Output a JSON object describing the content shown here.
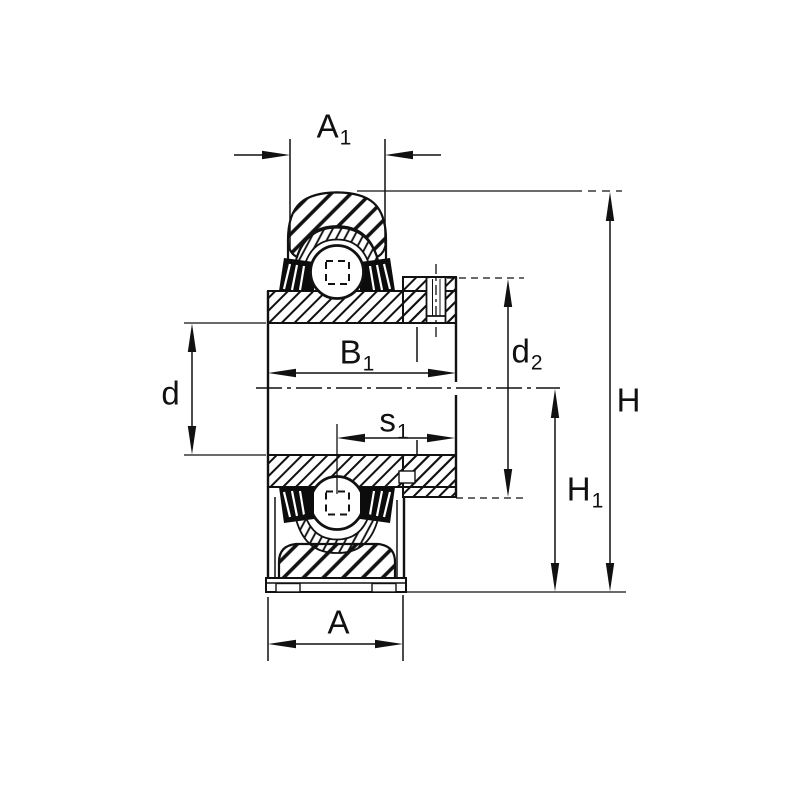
{
  "labels": {
    "a1": {
      "base": "A",
      "sub": "1"
    },
    "b1": {
      "base": "B",
      "sub": "1"
    },
    "d": {
      "base": "d",
      "sub": ""
    },
    "s1": {
      "base": "s",
      "sub": "1"
    },
    "d2": {
      "base": "d",
      "sub": "2"
    },
    "h": {
      "base": "H",
      "sub": ""
    },
    "h1": {
      "base": "H",
      "sub": "1"
    },
    "a": {
      "base": "A",
      "sub": ""
    }
  },
  "colors": {
    "line": "#111111",
    "background": "#ffffff",
    "seal_fill": "#0c0c0c"
  }
}
